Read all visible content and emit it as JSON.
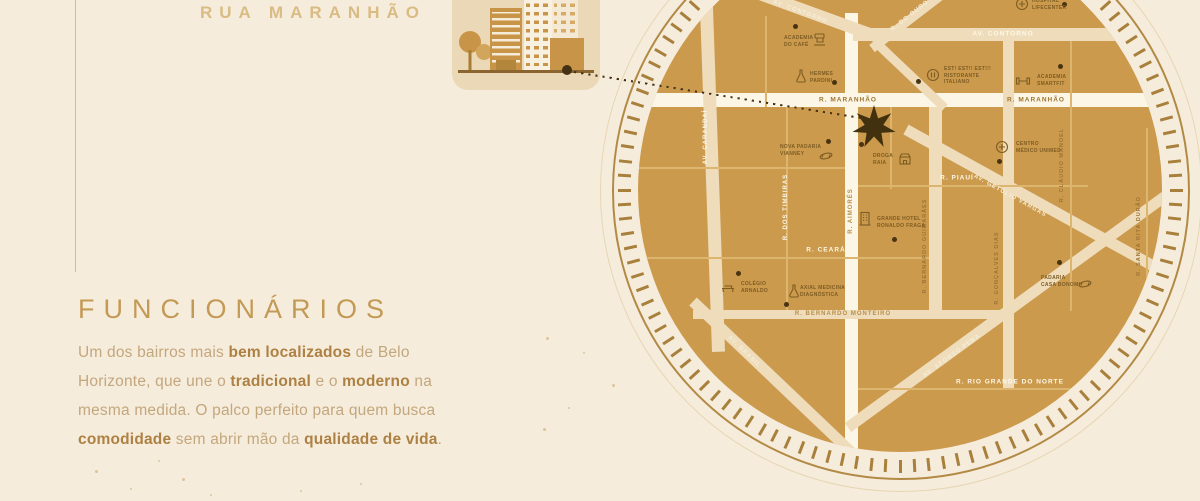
{
  "header": {
    "street_title": "RUA MARANHÃO"
  },
  "intro": {
    "heading": "FUNCIONÁRIOS",
    "paragraph_lines": [
      [
        {
          "t": "Um dos bairros mais ",
          "b": 0
        },
        {
          "t": "bem localizados",
          "b": 1
        },
        {
          "t": " de Belo",
          "b": 0
        }
      ],
      [
        {
          "t": "Horizonte, que une o ",
          "b": 0
        },
        {
          "t": "tradicional",
          "b": 1
        },
        {
          "t": " e o ",
          "b": 0
        },
        {
          "t": "moderno",
          "b": 1
        },
        {
          "t": " na",
          "b": 0
        }
      ],
      [
        {
          "t": "mesma medida. O palco perfeito para quem busca",
          "b": 0
        }
      ],
      [
        {
          "t": "comodidade",
          "b": 1
        },
        {
          "t": " sem abrir mão da ",
          "b": 0
        },
        {
          "t": "qualidade de vida",
          "b": 1
        },
        {
          "t": ".",
          "b": 0
        }
      ]
    ]
  },
  "map": {
    "colors": {
      "cream": "#f7eed8",
      "white": "#fdf8e8",
      "brown": "#9c7434",
      "gold": "#b5904c",
      "gold2": "#b78f4a"
    },
    "disc_color": "#cc9a4d",
    "streets": [
      {
        "name": "r-maranhao",
        "x": 0,
        "y": 165,
        "w": 524,
        "h": 14,
        "rot": 0,
        "color": "white"
      },
      {
        "name": "rua-central",
        "x": 207,
        "y": 85,
        "w": 13,
        "h": 440,
        "rot": 0,
        "color": "white"
      },
      {
        "name": "av-contorno",
        "x": 215,
        "y": 100,
        "w": 310,
        "h": 13,
        "rot": 0,
        "color": "cream"
      },
      {
        "name": "av-contorno-diagonal",
        "x": 97,
        "y": 51,
        "w": 150,
        "h": 12,
        "rot": 20,
        "color": "cream"
      },
      {
        "name": "r-do-ouro-upper",
        "x": 234,
        "y": 116,
        "w": 100,
        "h": 9,
        "rot": -37.5,
        "color": "cream"
      },
      {
        "name": "r-do-ouro-lower",
        "x": 240,
        "y": 112,
        "w": 92,
        "h": 9,
        "rot": 43.5,
        "color": "cream"
      },
      {
        "name": "av-carandai",
        "x": 59,
        "y": -6,
        "w": 13,
        "h": 430,
        "rot": -2,
        "color": "cream"
      },
      {
        "name": "r-bernardo-guimaraes",
        "x": 291,
        "y": 179,
        "w": 13,
        "h": 212,
        "rot": 0,
        "color": "cream"
      },
      {
        "name": "r-goncalves-dias",
        "x": 365,
        "y": 110,
        "w": 11,
        "h": 352,
        "rot": 0,
        "color": "cream"
      },
      {
        "name": "r-bernardo-monteiro",
        "x": 55,
        "y": 382,
        "w": 320,
        "h": 9,
        "rot": 0,
        "color": "cream"
      },
      {
        "name": "av-getulio-vargas",
        "x": 268,
        "y": 196,
        "w": 292,
        "h": 11,
        "rot": 28.9,
        "color": "cream"
      },
      {
        "name": "av-afonso-pena",
        "x": 210,
        "y": 494,
        "w": 392,
        "h": 11,
        "rot": -36.1,
        "color": "cream"
      },
      {
        "name": "av-brasil",
        "x": 55,
        "y": 368,
        "w": 228,
        "h": 11,
        "rot": 43.6,
        "color": "cream"
      }
    ],
    "gridlines": [
      {
        "x": 127,
        "y": 88,
        "w": 2,
        "h": 91
      },
      {
        "x": 148,
        "y": 179,
        "w": 2,
        "h": 203
      },
      {
        "x": 252,
        "y": 179,
        "w": 2,
        "h": 82
      },
      {
        "x": 432,
        "y": 113,
        "w": 2,
        "h": 270
      },
      {
        "x": 508,
        "y": 200,
        "w": 2,
        "h": 210
      },
      {
        "x": 0,
        "y": 239,
        "w": 207,
        "h": 2
      },
      {
        "x": 220,
        "y": 257,
        "w": 230,
        "h": 2
      },
      {
        "x": 0,
        "y": 329,
        "w": 291,
        "h": 2
      },
      {
        "x": 220,
        "y": 460,
        "w": 290,
        "h": 2
      }
    ],
    "street_labels": [
      {
        "text": "AV. CONTORNO",
        "x": 162,
        "y": 84,
        "rot": 20,
        "c": "cream",
        "s": 6
      },
      {
        "text": "R. DO OURO",
        "x": 272,
        "y": 88,
        "rot": -38,
        "c": "cream",
        "s": 6
      },
      {
        "text": "AV. CONTORNO",
        "x": 365,
        "y": 106,
        "rot": 0,
        "c": "white",
        "s": 6.5
      },
      {
        "text": "R. MARANHÃO",
        "x": 210,
        "y": 172,
        "rot": 0,
        "c": "brown",
        "s": 6.5
      },
      {
        "text": "R. MARANHÃO",
        "x": 398,
        "y": 172,
        "rot": 0,
        "c": "brown",
        "s": 6.5
      },
      {
        "text": "AV. CARANDAÍ",
        "x": 68,
        "y": 209,
        "rot": -90,
        "c": "white",
        "s": 6
      },
      {
        "text": "R. DOS TIMBIRAS",
        "x": 148,
        "y": 279,
        "rot": -90,
        "c": "white",
        "s": 6
      },
      {
        "text": "R. AIMORÉS",
        "x": 213,
        "y": 283,
        "rot": -90,
        "c": "gold",
        "s": 6
      },
      {
        "text": "R. PIAUÍ",
        "x": 319,
        "y": 250,
        "rot": 0,
        "c": "white",
        "s": 6.5
      },
      {
        "text": "R. BERNARDO GUIMARÃES",
        "x": 287,
        "y": 318,
        "rot": -90,
        "c": "brown",
        "s": 5.5
      },
      {
        "text": "R. CEARÁ",
        "x": 188,
        "y": 322,
        "rot": 0,
        "c": "white",
        "s": 6.5
      },
      {
        "text": "R. GONÇALVES DIAS",
        "x": 359,
        "y": 340,
        "rot": -90,
        "c": "brown",
        "s": 5.5
      },
      {
        "text": "R. CLÁUDIO MANOEL",
        "x": 424,
        "y": 237,
        "rot": -90,
        "c": "brown",
        "s": 5.5
      },
      {
        "text": "R. SANTA RITA DURÃO",
        "x": 501,
        "y": 308,
        "rot": -90,
        "c": "brown",
        "s": 5.5
      },
      {
        "text": "AV. GETÚLIO VARGAS",
        "x": 372,
        "y": 268,
        "rot": 29,
        "c": "cream",
        "s": 6
      },
      {
        "text": "R. BERNARDO MONTEIRO",
        "x": 205,
        "y": 386,
        "rot": 0,
        "c": "gold2",
        "s": 6
      },
      {
        "text": "AV. BRASIL",
        "x": 106,
        "y": 424,
        "rot": 44,
        "c": "cream",
        "s": 6
      },
      {
        "text": "AV. AFONSO PENA",
        "x": 314,
        "y": 428,
        "rot": -36,
        "c": "cream",
        "s": 6
      },
      {
        "text": "R. RIO GRANDE DO NORTE",
        "x": 372,
        "y": 454,
        "rot": 0,
        "c": "white",
        "s": 6.5
      }
    ],
    "pois": [
      {
        "id": "academia-do-cafe",
        "lines": [
          "ACADEMIA",
          "DO CAFÉ"
        ],
        "icon": "coffee-machine-icon",
        "dot": [
          155,
          96
        ],
        "icon_xy": [
          174,
          104
        ],
        "label_xy": [
          146,
          107
        ]
      },
      {
        "id": "hermes-pardini",
        "lines": [
          "HERMES",
          "PARDINI"
        ],
        "icon": "flask-icon",
        "dot": [
          194,
          152
        ],
        "icon_xy": [
          155,
          140
        ],
        "label_xy": [
          172,
          143
        ]
      },
      {
        "id": "hospital-lifecenter",
        "lines": [
          "HOSPITAL",
          "LIFECENTER"
        ],
        "icon": "medical-circle-icon",
        "dot": [
          424,
          74
        ],
        "icon_xy": [
          376,
          68
        ],
        "label_xy": [
          394,
          70
        ]
      },
      {
        "id": "est-est-est-ristorante",
        "lines": [
          "EST! EST!! EST!!!",
          "RISTORANTE",
          "ITALIANO"
        ],
        "icon": "restaurant-icon",
        "dot": [
          278,
          151
        ],
        "icon_xy": [
          287,
          139
        ],
        "label_xy": [
          306,
          138
        ]
      },
      {
        "id": "academia-smartfit",
        "lines": [
          "ACADEMIA",
          "SMARTFIT"
        ],
        "icon": "dumbbell-icon",
        "dot": [
          420,
          136
        ],
        "icon_xy": [
          377,
          145
        ],
        "label_xy": [
          399,
          146
        ]
      },
      {
        "id": "nova-padaria-vianney",
        "lines": [
          "NOVA PADARIA",
          "VIANNEY"
        ],
        "icon": "croissant-icon",
        "dot": [
          188,
          211
        ],
        "icon_xy": [
          180,
          220
        ],
        "label_xy": [
          142,
          216
        ]
      },
      {
        "id": "droga-raia",
        "lines": [
          "DROGA",
          "RAIA"
        ],
        "icon": "store-icon",
        "dot": [
          221,
          214
        ],
        "icon_xy": [
          259,
          223
        ],
        "label_xy": [
          235,
          225
        ]
      },
      {
        "id": "centro-medico-unimed",
        "lines": [
          "CENTRO",
          "MÉDICO UNIMED"
        ],
        "icon": "medical-circle-icon",
        "dot": [
          359,
          231
        ],
        "icon_xy": [
          356,
          211
        ],
        "label_xy": [
          378,
          213
        ]
      },
      {
        "id": "grande-hotel-ronaldo-fraga",
        "lines": [
          "GRANDE HOTEL",
          "RONALDO FRAGA"
        ],
        "icon": "hotel-icon",
        "dot": [
          254,
          309
        ],
        "icon_xy": [
          219,
          283
        ],
        "label_xy": [
          239,
          288
        ]
      },
      {
        "id": "colegio-arnaldo",
        "lines": [
          "COLÉGIO",
          "ARNALDO"
        ],
        "icon": "bench-icon",
        "dot": [
          98,
          343
        ],
        "icon_xy": [
          82,
          351
        ],
        "label_xy": [
          103,
          353
        ]
      },
      {
        "id": "axial-medicina-diagnostica",
        "lines": [
          "AXIAL MEDICINA",
          "DIAGNÓSTICA"
        ],
        "icon": "flask-icon",
        "dot": [
          146,
          374
        ],
        "icon_xy": [
          148,
          355
        ],
        "label_xy": [
          162,
          357
        ]
      },
      {
        "id": "padaria-casa-bonomi",
        "lines": [
          "PADARIA",
          "CASA BONOMI"
        ],
        "icon": "croissant-icon",
        "dot": [
          419,
          332
        ],
        "icon_xy": [
          439,
          348
        ],
        "label_xy": [
          403,
          347
        ]
      }
    ],
    "marker": {
      "type": "seven-point-star",
      "x": 236,
      "y": 199
    }
  }
}
